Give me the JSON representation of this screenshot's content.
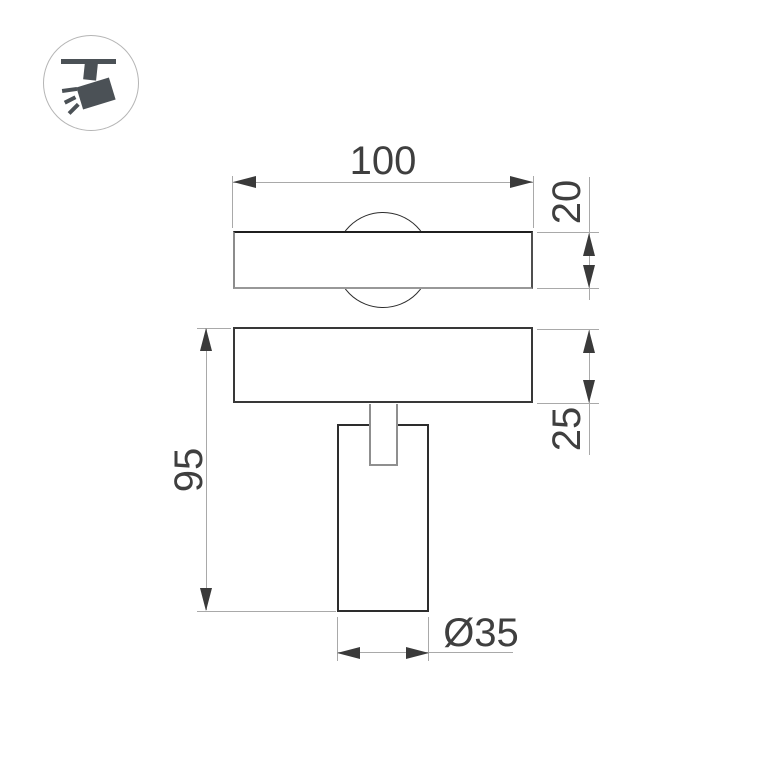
{
  "icon": "track-spotlight-icon",
  "dimensions": {
    "track_width": "100",
    "track_height": "20",
    "overall_height": "95",
    "plate_height": "25",
    "body_diameter": "Ø35"
  },
  "colors": {
    "background": "#ffffff",
    "outline": "#2d2d2d",
    "outline_soft": "#8f8f8f",
    "dim_line": "#a9a9a9",
    "arrow": "#3a3a3a",
    "text": "#3f3f3f",
    "icon": "#4b5156",
    "icon_circle": "#b5b5b5"
  }
}
